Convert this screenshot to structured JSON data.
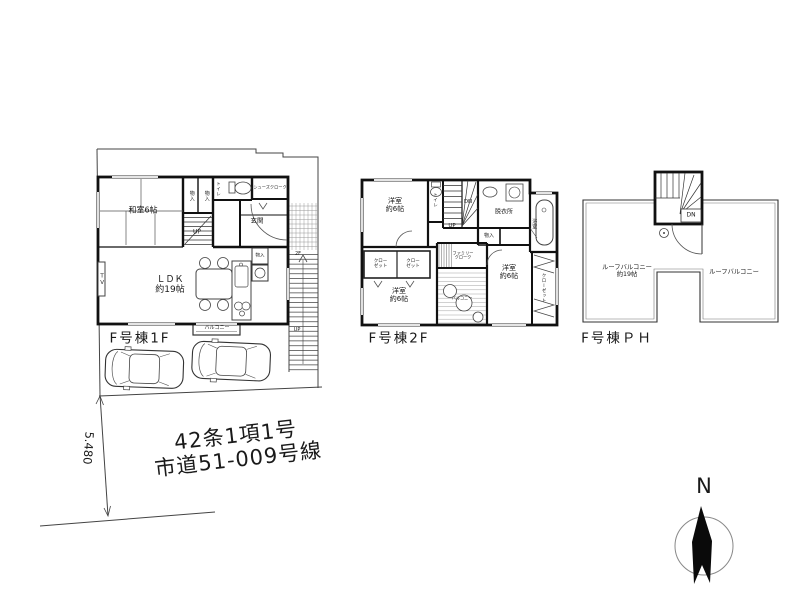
{
  "floor1": {
    "name": "F号棟1F",
    "washitsu": "和室6帖",
    "ldk_line1": "ＬＤＫ",
    "ldk_line2": "約19帖",
    "balcony": "バルコニー",
    "entrance": "玄関",
    "toilet": "トイレ",
    "shoe_closet": "シューズクローク",
    "storage1": "物入",
    "storage2": "物入",
    "storage3": "物入",
    "tv": "TV",
    "stairs_up": "UP",
    "ext_stairs_up": "UP",
    "to_2f": "2F"
  },
  "floor2": {
    "name": "F号棟2F",
    "bed1_line1": "洋室",
    "bed1_line2": "約6帖",
    "bed2_line1": "洋室",
    "bed2_line2": "約6帖",
    "bed3_line1": "洋室",
    "bed3_line2": "約6帖",
    "toilet": "トイレ",
    "stairs_dn": "DN",
    "stairs_up": "UP",
    "dressing": "脱衣所",
    "bath": "浴室",
    "storage": "物入",
    "closet1_line1": "クロー",
    "closet1_line2": "ゼット",
    "closet2_line1": "クロー",
    "closet2_line2": "ゼット",
    "family_closet_line1": "ファミリー",
    "family_closet_line2": "クローク",
    "balcony": "バルコニー",
    "closet3": "クローゼット"
  },
  "floorph": {
    "name": "F号棟ＰＨ",
    "stairs_dn": "DN",
    "roof_balcony_left_line1": "ルーフバルコニー",
    "roof_balcony_left_line2": "約19帖",
    "roof_balcony_right": "ルーフバルコニー"
  },
  "site": {
    "dimension": "5.480",
    "road_line1": "42条1項1号",
    "road_line2": "市道51-009号線"
  },
  "compass": {
    "north": "N"
  }
}
